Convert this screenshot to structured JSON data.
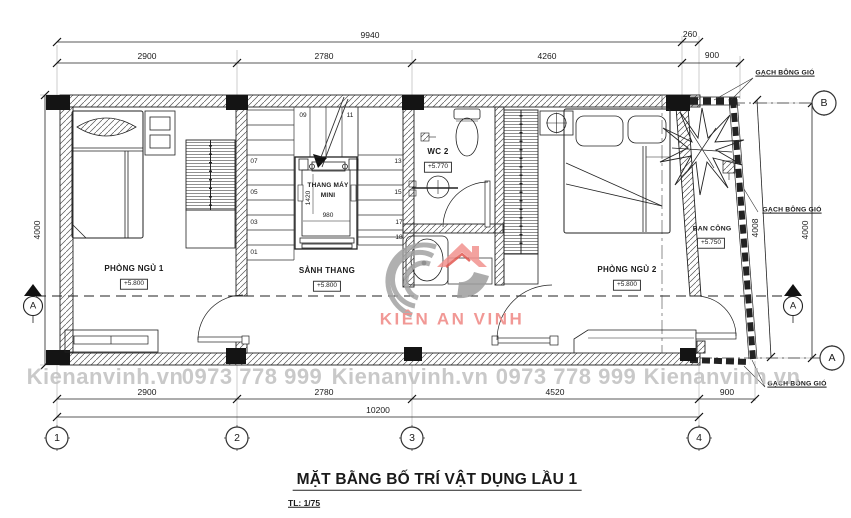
{
  "title": "MẶT BẰNG BỐ TRÍ VẬT DỤNG LẦU 1",
  "scale": "TL: 1/75",
  "watermark": {
    "site": "Kienanvinh.vn",
    "phone": "0973 778 999",
    "brand": "KIÊN AN VINH"
  },
  "rooms": {
    "bedroom1": {
      "name": "PHÒNG NGỦ 1",
      "level": "+5.800"
    },
    "stair_hall": {
      "name": "SẢNH THANG",
      "level": "+5.800"
    },
    "wc2": {
      "name": "WC 2",
      "level": "+5.770"
    },
    "bedroom2": {
      "name": "PHÒNG NGỦ 2",
      "level": "+5.800"
    },
    "balcony": {
      "name": "BAN CÔNG",
      "level": "+5.750"
    }
  },
  "elevator": {
    "name_line1": "THANG MÁY",
    "name_line2": "MINI",
    "cabin_depth": "1420",
    "cabin_width": "980"
  },
  "stair_steps": [
    "01",
    "03",
    "05",
    "07",
    "09",
    "11",
    "13",
    "15",
    "17",
    "18"
  ],
  "dimensions": {
    "top": {
      "total": "9940",
      "a": "2900",
      "b": "2780",
      "c": "4260",
      "offset": "260",
      "balcony": "900"
    },
    "bottom": {
      "a": "2900",
      "b": "2780",
      "c": "4520",
      "balcony": "900",
      "total": "10200"
    },
    "left": {
      "height": "4000"
    },
    "right": {
      "slant": "4008",
      "height": "4000"
    }
  },
  "grid": {
    "c1": "1",
    "c2": "2",
    "c3": "3",
    "c4": "4",
    "rA": "A",
    "rB": "B",
    "section": "A"
  },
  "notes": {
    "vent_brick": "GẠCH BÔNG GIÓ"
  },
  "colors": {
    "line": "#1c1c1c",
    "watermark_gray": "#bcbcbc",
    "brand_pink": "#f0908d",
    "logo_gray": "#9e9e9e"
  }
}
